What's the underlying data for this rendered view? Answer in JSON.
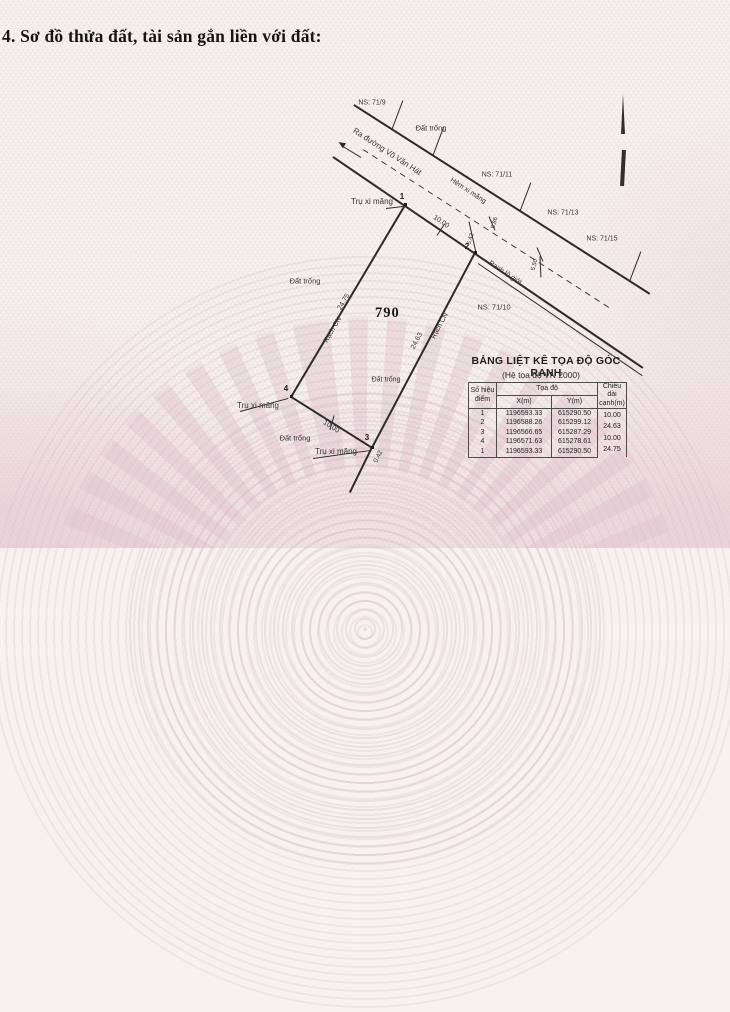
{
  "page": {
    "title": "4. Sơ đồ thửa đất, tài sản gắn liền với đất:"
  },
  "diagram": {
    "parcel_number": "790",
    "labels": [
      {
        "id": "ns-71-9",
        "text": "NS: 71/9"
      },
      {
        "id": "dat-trong-top",
        "text": "Đất trống"
      },
      {
        "id": "ra-duong-vo-van-hat",
        "text": "Ra đường Võ Văn Hát"
      },
      {
        "id": "hem-xi-mang",
        "text": "Hẻm xi măng"
      },
      {
        "id": "ns-71-11",
        "text": "NS: 71/11"
      },
      {
        "id": "ns-71-13",
        "text": "NS: 71/13"
      },
      {
        "id": "ns-71-15",
        "text": "NS: 71/15"
      },
      {
        "id": "ranh-lo-gioi",
        "text": "Ranh lộ giới"
      },
      {
        "id": "ns-71-10",
        "text": "NS: 71/10"
      },
      {
        "id": "tru-xi-mang-1",
        "text": "Trụ xi măng"
      },
      {
        "id": "tru-xi-mang-4",
        "text": "Trụ xi măng"
      },
      {
        "id": "tru-xi-mang-3",
        "text": "Trụ xi măng"
      },
      {
        "id": "dat-trong-left",
        "text": "Đất trống"
      },
      {
        "id": "dat-trong-mid",
        "text": "Đất trống"
      },
      {
        "id": "dat-trong-bottom",
        "text": "Đất trống"
      },
      {
        "id": "rach-cn-left",
        "text": "Rạch CN"
      },
      {
        "id": "rach-cn-right",
        "text": "Rạch CN"
      },
      {
        "id": "dim-10-00-top",
        "text": "10.00"
      },
      {
        "id": "dim-24-75",
        "text": "24.75"
      },
      {
        "id": "dim-24-63",
        "text": "24.63"
      },
      {
        "id": "dim-10-00-bottom",
        "text": "10.00"
      },
      {
        "id": "dim-0-42",
        "text": "0.42"
      },
      {
        "id": "dim-5-86",
        "text": "5.86"
      },
      {
        "id": "dim-5-42",
        "text": "5.42"
      },
      {
        "id": "dim-5-50",
        "text": "5.50"
      },
      {
        "id": "point-1",
        "text": "1"
      },
      {
        "id": "point-2",
        "text": "2"
      },
      {
        "id": "point-3",
        "text": "3"
      },
      {
        "id": "point-4",
        "text": "4"
      }
    ],
    "icons": {
      "north_arrow": "north-arrow"
    }
  },
  "table": {
    "title": "BẢNG LIỆT KÊ TỌA ĐỘ GÓC RANH",
    "subtitle": "(Hệ tọa độ VN 2000)",
    "col_point": "Số hiệu điểm",
    "col_coord_group": "Tọa độ",
    "col_x": "X(m)",
    "col_y": "Y(m)",
    "col_length": "Chiều dài cạnh(m)",
    "rows": [
      {
        "point": "1",
        "x": "1196593.33",
        "y": "615290.50"
      },
      {
        "point": "2",
        "x": "1196588.26",
        "y": "615299.12"
      },
      {
        "point": "3",
        "x": "1196566.65",
        "y": "615287.29"
      },
      {
        "point": "4",
        "x": "1196571.63",
        "y": "615278.61"
      },
      {
        "point": "1",
        "x": "1196593.33",
        "y": "615290.50"
      }
    ],
    "edge_lengths": [
      "10.00",
      "24.63",
      "10.00",
      "24.75"
    ]
  }
}
